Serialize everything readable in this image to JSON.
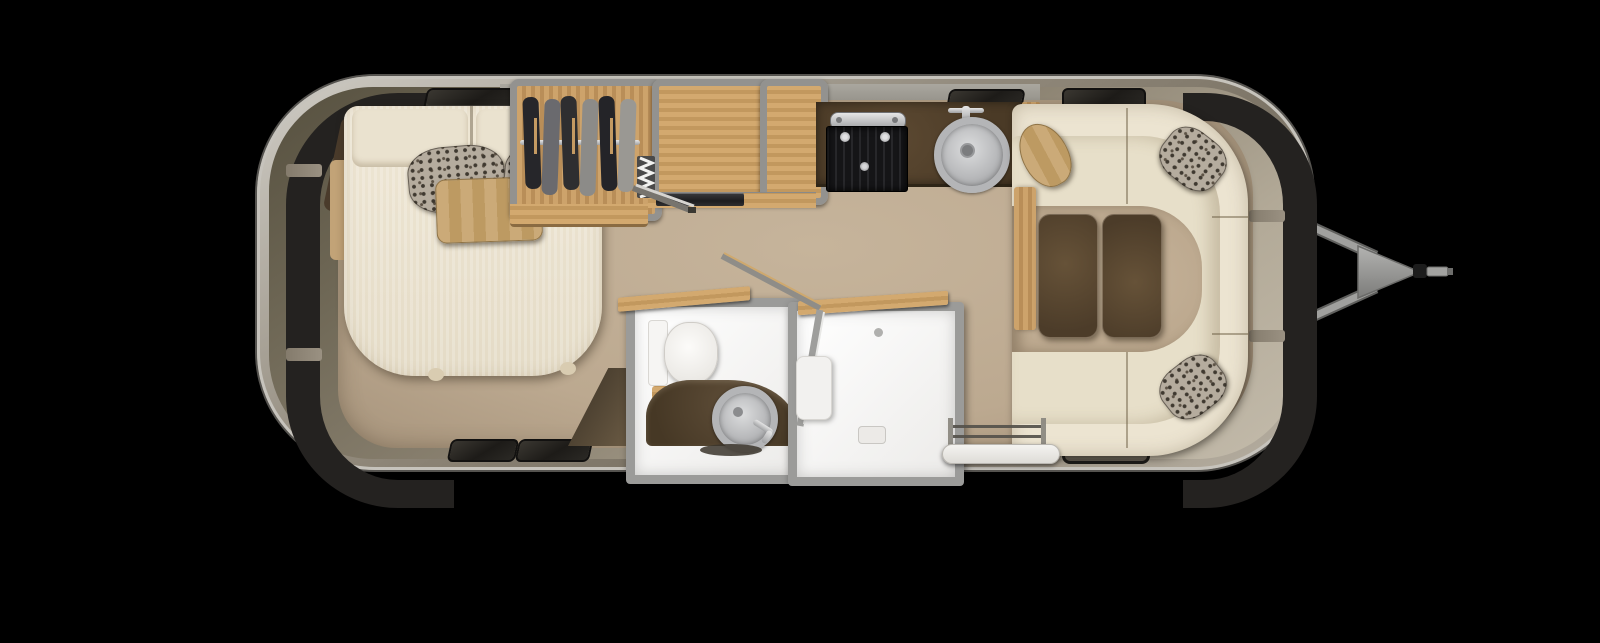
{
  "meta": {
    "description": "Top-down floor plan of a travel trailer with rear bedroom, wardrobe, galley kitchen, split bath with shower, wraparound lounge and A-frame hitch",
    "orientation": "hitch-on-right",
    "visible_text": ""
  },
  "palette": {
    "background": "#000000",
    "shell_outer": "#c6c3bc",
    "shell_mid": "#8e8678",
    "shell_dark": "#615948",
    "window_band": "#242220",
    "floor": "#c6b49b",
    "floor_dark": "#a7947c",
    "wall_gray": "#9d9a93",
    "wood_light": "#cda36b",
    "wood_mid": "#b98e58",
    "counter_brown": "#4a3a26",
    "appliance_black": "#17171a",
    "stainless": "#b9babd",
    "cream": "#ece4d1",
    "cream_seat": "#e7dfc9",
    "cushion_brown": "#57452f",
    "tan_accent": "#c7a371",
    "leopard_base": "#b5ac9e",
    "leopard_spot": "#3f3930",
    "bath_white": "#f3f2ef",
    "bath_trim": "#9b9b99",
    "hitch_gray": "#949492"
  },
  "labels": {
    "scene": "Travel trailer floor plan",
    "shell": "Aluminum trailer shell",
    "bed": "Bed with pillows",
    "wardrobe": "Wardrobe with hanging clothes",
    "cabinet_large": "Overhead cabinet",
    "cabinet_small": "Overhead cabinet",
    "accordion_door": "Folding accordion door",
    "galley_counter": "Galley countertop",
    "stove": "Two-burner stove",
    "kitchen_sink": "Round kitchen sink",
    "toilet_room": "Toilet and vanity room",
    "toilet": "Toilet",
    "bath_sink": "Round bathroom sink",
    "shower": "Shower stall",
    "sofa": "Wraparound lounge sofa",
    "tables": "Twin table tops",
    "entry_step": "Entry step",
    "hitch": "A-frame tow hitch",
    "window": "Window",
    "vent": "Vent"
  }
}
